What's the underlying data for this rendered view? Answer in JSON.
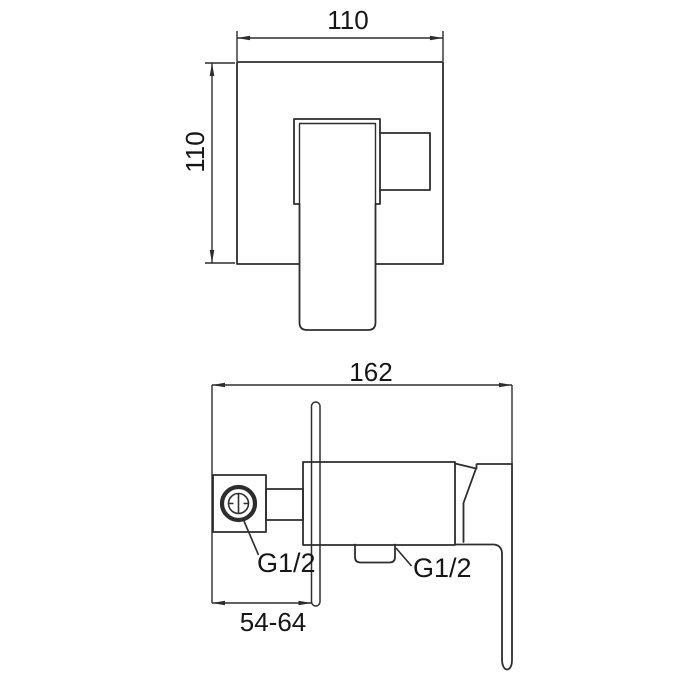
{
  "colors": {
    "line": "#2d2d2d",
    "text": "#161616",
    "background": "#ffffff"
  },
  "front_view": {
    "width_dim": "110",
    "height_dim": "110"
  },
  "side_view": {
    "depth_dim": "162",
    "inlet_thread": "G1/2",
    "outlet_thread": "G1/2",
    "wall_range_dim": "54-64"
  }
}
